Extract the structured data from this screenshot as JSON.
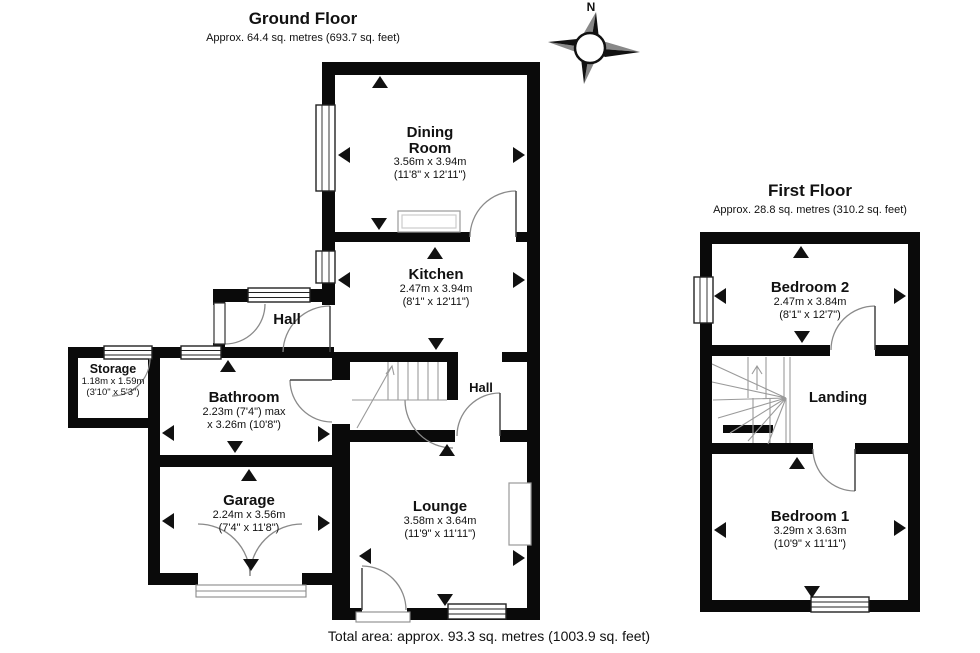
{
  "ground_floor": {
    "title": "Ground Floor",
    "area": "Approx. 64.4 sq. metres (693.7 sq. feet)"
  },
  "first_floor": {
    "title": "First Floor",
    "area": "Approx. 28.8 sq. metres (310.2 sq. feet)"
  },
  "compass": {
    "label": "N"
  },
  "total_area": "Total area: approx. 93.3 sq. metres (1003.9 sq. feet)",
  "rooms": {
    "dining": {
      "name": "Dining Room",
      "dim_metric": "3.56m x 3.94m",
      "dim_imperial": "(11'8\" x 12'11\")"
    },
    "kitchen": {
      "name": "Kitchen",
      "dim_metric": "2.47m x 3.94m",
      "dim_imperial": "(8'1\" x 12'11\")"
    },
    "hall_ground": {
      "name": "Hall"
    },
    "hall_inner": {
      "name": "Hall"
    },
    "storage": {
      "name": "Storage",
      "dim_metric": "1.18m x 1.59m",
      "dim_imperial": "(3'10\" x 5'3\")"
    },
    "bathroom": {
      "name": "Bathroom",
      "dim_metric": "2.23m (7'4\") max",
      "dim_imperial": "x 3.26m (10'8\")"
    },
    "garage": {
      "name": "Garage",
      "dim_metric": "2.24m x 3.56m",
      "dim_imperial": "(7'4\" x 11'8\")"
    },
    "lounge": {
      "name": "Lounge",
      "dim_metric": "3.58m x 3.64m",
      "dim_imperial": "(11'9\" x 11'11\")"
    },
    "bedroom2": {
      "name": "Bedroom 2",
      "dim_metric": "2.47m x 3.84m",
      "dim_imperial": "(8'1\" x 12'7\")"
    },
    "landing": {
      "name": "Landing"
    },
    "bedroom1": {
      "name": "Bedroom 1",
      "dim_metric": "3.29m x 3.63m",
      "dim_imperial": "(10'9\" x 11'11\")"
    }
  },
  "colors": {
    "wall": "#0a0a0a",
    "arc": "#8a8a8a",
    "stair": "#9a9a9a"
  }
}
